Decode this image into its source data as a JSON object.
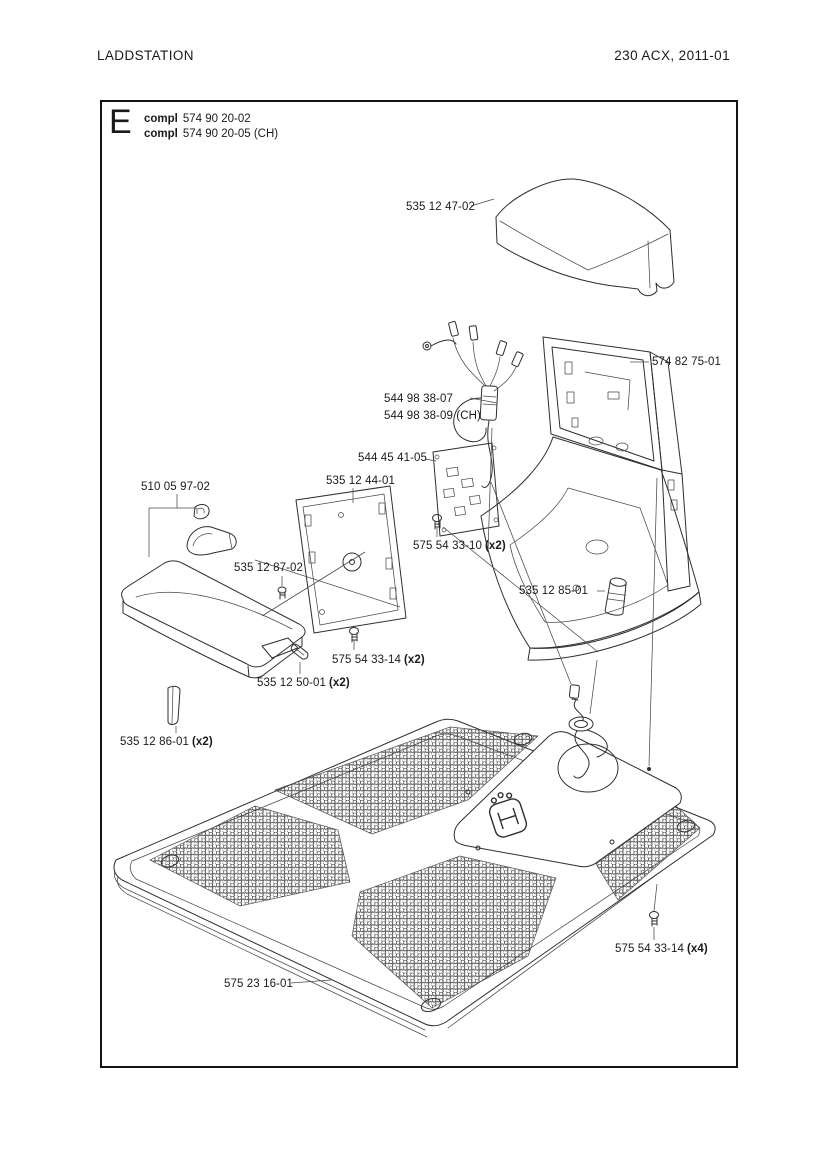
{
  "page": {
    "header_left": "LADDSTATION",
    "header_right": "230 ACX, 2011-01",
    "ink_color": "#2e2e2e"
  },
  "section": {
    "letter": "E",
    "variants": [
      {
        "label": "compl",
        "part_number": "574 90 20-02"
      },
      {
        "label": "compl",
        "part_number": "574 90 20-05 (CH)"
      }
    ]
  },
  "part_labels": [
    {
      "number": "535 12 47-02",
      "qty": ""
    },
    {
      "number": "574 82 75-01",
      "qty": ""
    },
    {
      "number": "544 98 38-07",
      "qty": ""
    },
    {
      "number": "544 98 38-09 (CH)",
      "qty": ""
    },
    {
      "number": "544 45 41-05",
      "qty": ""
    },
    {
      "number": "535 12 44-01",
      "qty": ""
    },
    {
      "number": "510 05 97-02",
      "qty": ""
    },
    {
      "number": "575 54 33-10",
      "qty": "(x2)"
    },
    {
      "number": "535 12 87-02",
      "qty": ""
    },
    {
      "number": "535 12 85-01",
      "qty": ""
    },
    {
      "number": "575 54 33-14",
      "qty": "(x2)"
    },
    {
      "number": "535 12 50-01",
      "qty": "(x2)"
    },
    {
      "number": "535 12 86-01",
      "qty": "(x2)"
    },
    {
      "number": "575 54 33-14",
      "qty": "(x4)"
    },
    {
      "number": "575 23 16-01",
      "qty": ""
    }
  ]
}
